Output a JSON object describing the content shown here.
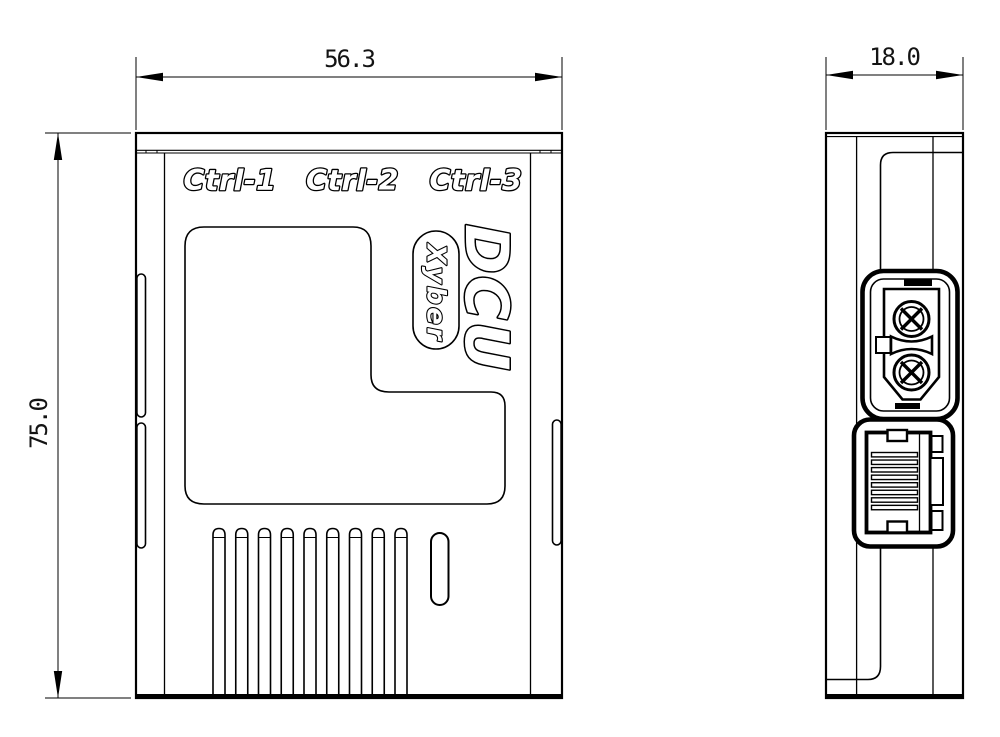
{
  "front_view": {
    "width_mm": "56.3",
    "height_mm": "75.0",
    "port_labels": [
      "Ctrl-1",
      "Ctrl-2",
      "Ctrl-3"
    ],
    "brand": "DCU",
    "logo_badge": "Xyber",
    "vent_slot_count": 9
  },
  "side_view": {
    "depth_mm": "18.0",
    "connectors": [
      "xt30-power-connector",
      "rj45-ethernet-port"
    ]
  },
  "colors": {
    "line": "#000000",
    "background": "#ffffff"
  }
}
